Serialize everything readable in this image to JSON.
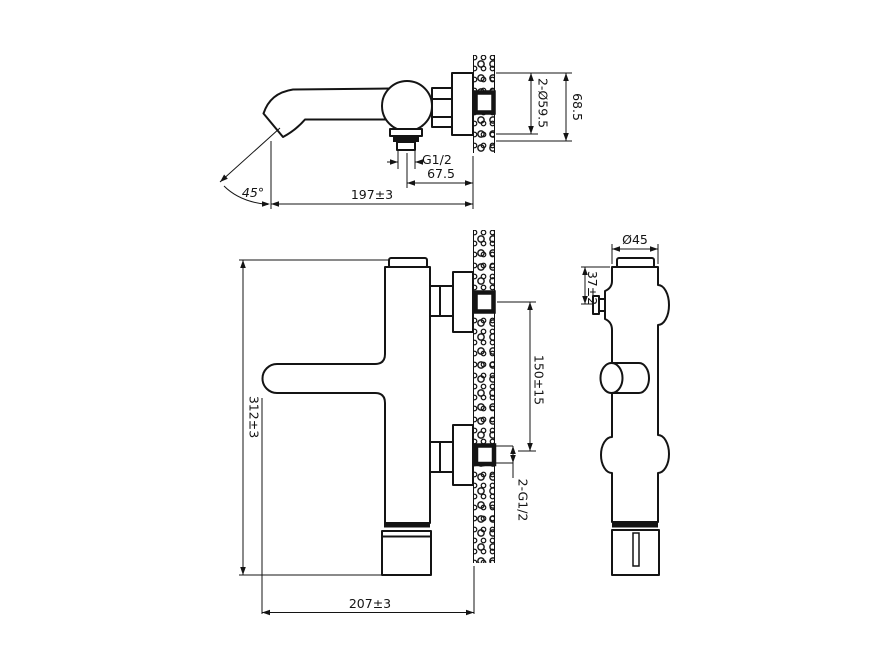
{
  "drawing": {
    "top_view": {
      "dims": {
        "spout_angle": "45°",
        "spout_length": "197±3",
        "outlet_thread": "G1/2",
        "outlet_offset": "67.5",
        "escutcheon_diameter": "2-Ø59.5",
        "escutcheon_height": "68.5"
      }
    },
    "front_view": {
      "dims": {
        "total_height": "312±3",
        "inlet_spacing": "150±15",
        "inlet_threads": "2-G1/2",
        "total_width": "207±3"
      }
    },
    "side_view": {
      "dims": {
        "body_diameter": "Ø45",
        "inlet_offset": "37±2"
      }
    }
  }
}
